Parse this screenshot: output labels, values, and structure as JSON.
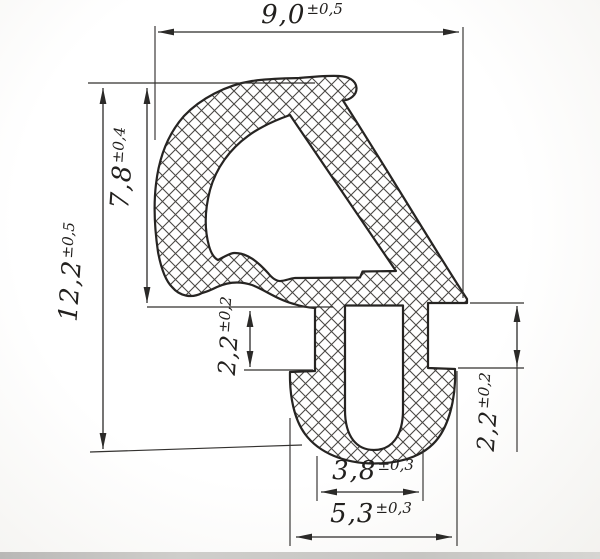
{
  "dimensions": {
    "width_top": {
      "value": "9,0",
      "tolerance": "±0,5"
    },
    "total_height": {
      "value": "12,2",
      "tolerance": "±0,5"
    },
    "upper_height": {
      "value": "7,8",
      "tolerance": "±0,4"
    },
    "left_notch": {
      "value": "2,2",
      "tolerance": "±0,2"
    },
    "right_notch": {
      "value": "2,2",
      "tolerance": "±0,2"
    },
    "slot_width": {
      "value": "3,8",
      "tolerance": "±0,3"
    },
    "foot_width": {
      "value": "5,3",
      "tolerance": "±0,3"
    }
  },
  "colors": {
    "line": "#262422",
    "hatch": "#4a4844",
    "background": "#f7f6f3"
  }
}
